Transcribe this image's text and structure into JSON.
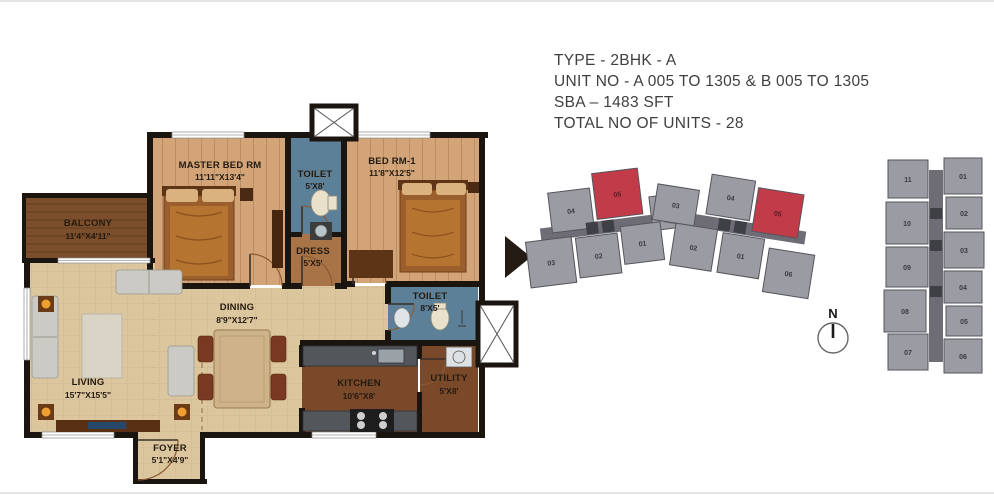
{
  "info": {
    "type": "TYPE - 2BHK - A",
    "unit_no": "UNIT NO - A 005 TO 1305 & B 005 TO 1305",
    "sba": "SBA – 1483 SFT",
    "total_units": "TOTAL NO OF UNITS - 28"
  },
  "rooms": {
    "master_bed": {
      "name": "MASTER BED RM",
      "dim": "11'11\"X13'4\""
    },
    "toilet_1": {
      "name": "TOILET",
      "dim": "5'X8'"
    },
    "bed_1": {
      "name": "BED RM-1",
      "dim": "11'8\"X12'5\""
    },
    "balcony": {
      "name": "BALCONY",
      "dim": "11'4\"X4'11\""
    },
    "dress": {
      "name": "DRESS",
      "dim": "5'X5'"
    },
    "toilet_2": {
      "name": "TOILET",
      "dim": "8'X5'"
    },
    "living": {
      "name": "LIVING",
      "dim": "15'7\"X15'5\""
    },
    "dining": {
      "name": "DINING",
      "dim": "8'9\"X12'7\""
    },
    "kitchen": {
      "name": "KITCHEN",
      "dim": "10'6\"X8'"
    },
    "utility": {
      "name": "UTILITY",
      "dim": "5'X8'"
    },
    "foyer": {
      "name": "FOYER",
      "dim": "5'1\"X4'9\""
    }
  },
  "keyplan_wings": {
    "wing_a": {
      "units": [
        {
          "no": "04"
        },
        {
          "no": "05",
          "highlight": true
        },
        {
          "no": "06"
        },
        {
          "no": "03"
        },
        {
          "no": "02"
        },
        {
          "no": "01"
        }
      ]
    },
    "wing_b": {
      "units": [
        {
          "no": "03"
        },
        {
          "no": "04"
        },
        {
          "no": "05",
          "highlight": true
        },
        {
          "no": "02"
        },
        {
          "no": "01"
        },
        {
          "no": "06"
        }
      ]
    }
  },
  "keyplan_tower": {
    "left_units": [
      "11",
      "10",
      "09",
      "08",
      "07"
    ],
    "right_units": [
      "01",
      "02",
      "03",
      "04",
      "05",
      "06"
    ]
  },
  "compass": {
    "label": "N"
  },
  "colors": {
    "wall": "#1b1510",
    "floor_living": "#dcc69e",
    "floor_bedroom": "#d2a478",
    "floor_dress": "#a87347",
    "floor_balcony": "#7c4e2b",
    "floor_kitchen": "#7a492a",
    "floor_toilet": "#5d8099",
    "building_gray": "#9b9ba3",
    "corridor_gray": "#6e6d75",
    "unit_highlight": "#c23b49",
    "info_text": "#3f3f3f"
  }
}
